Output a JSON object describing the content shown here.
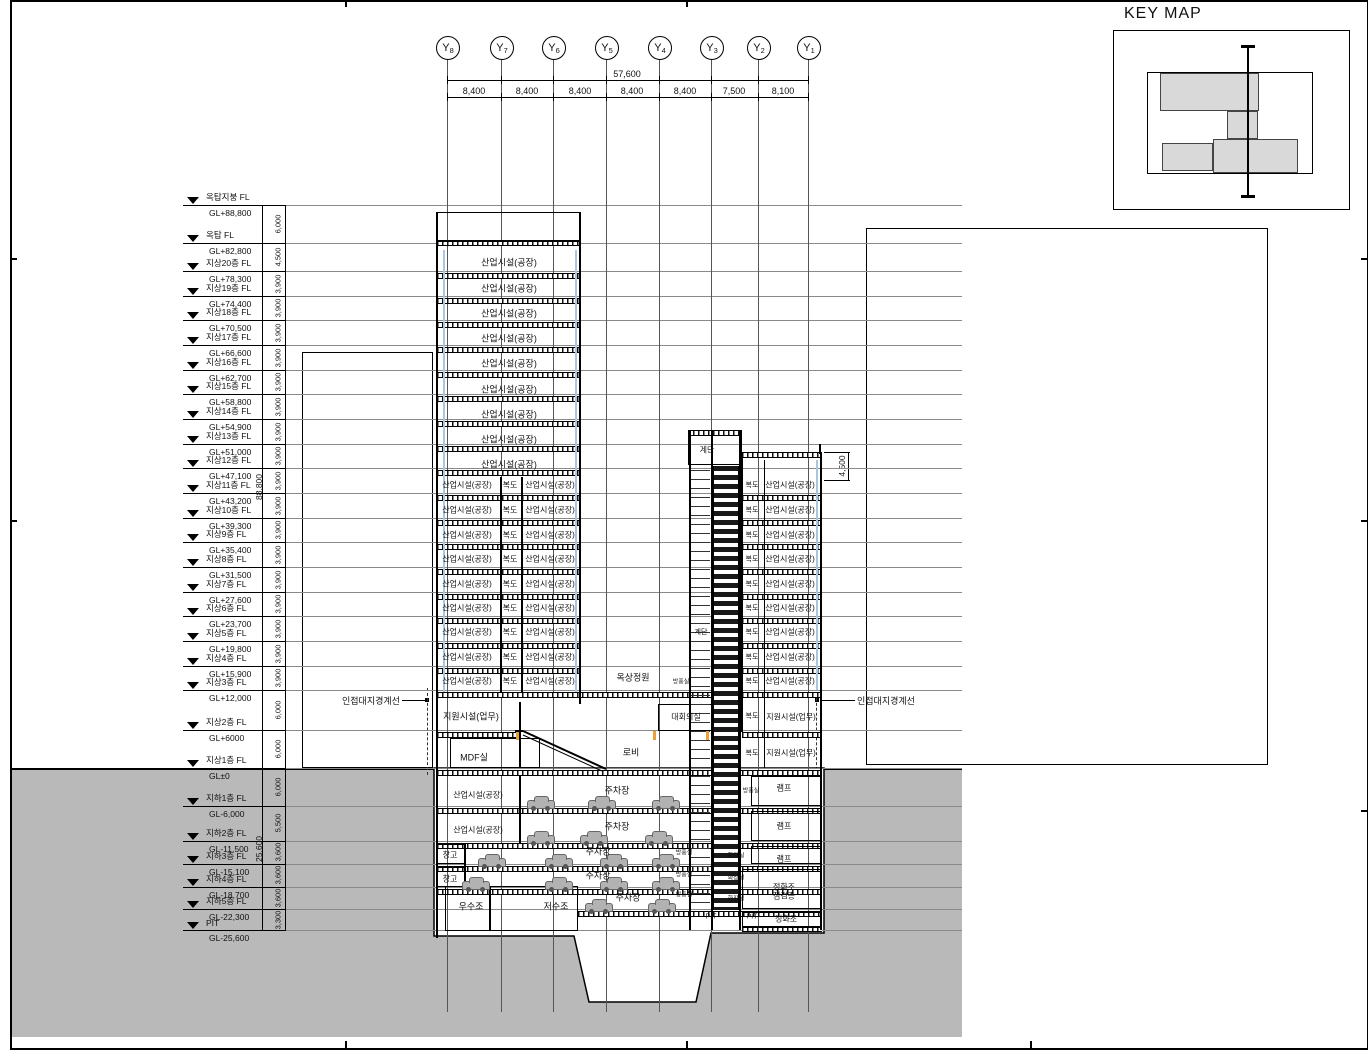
{
  "key_map": {
    "title": "KEY MAP"
  },
  "grid": {
    "overall": "57,600",
    "axis_prefix": "Y",
    "bubbles": [
      {
        "sub": "8",
        "x": 447
      },
      {
        "sub": "7",
        "x": 501
      },
      {
        "sub": "6",
        "x": 553
      },
      {
        "sub": "5",
        "x": 606
      },
      {
        "sub": "4",
        "x": 659
      },
      {
        "sub": "3",
        "x": 711
      },
      {
        "sub": "2",
        "x": 758
      },
      {
        "sub": "1",
        "x": 808
      }
    ],
    "spans": [
      {
        "t": "8,400",
        "x": 474
      },
      {
        "t": "8,400",
        "x": 527
      },
      {
        "t": "8,400",
        "x": 580
      },
      {
        "t": "8,400",
        "x": 632
      },
      {
        "t": "8,400",
        "x": 685
      },
      {
        "t": "7,500",
        "x": 734
      },
      {
        "t": "8,100",
        "x": 783
      }
    ]
  },
  "levels": [
    {
      "n": "옥탑지붕 FL",
      "gl": "GL+88,800",
      "y": 205
    },
    {
      "n": "옥탑 FL",
      "gl": "GL+82,800",
      "y": 243
    },
    {
      "n": "지상20층 FL",
      "gl": "GL+78,300",
      "y": 271
    },
    {
      "n": "지상19층 FL",
      "gl": "GL+74,400",
      "y": 296
    },
    {
      "n": "지상18층 FL",
      "gl": "GL+70,500",
      "y": 320
    },
    {
      "n": "지상17층 FL",
      "gl": "GL+66,600",
      "y": 345
    },
    {
      "n": "지상16층 FL",
      "gl": "GL+62,700",
      "y": 370
    },
    {
      "n": "지상15층 FL",
      "gl": "GL+58,800",
      "y": 394
    },
    {
      "n": "지상14층 FL",
      "gl": "GL+54,900",
      "y": 419
    },
    {
      "n": "지상13층 FL",
      "gl": "GL+51,000",
      "y": 444
    },
    {
      "n": "지상12층 FL",
      "gl": "GL+47,100",
      "y": 468
    },
    {
      "n": "지상11층 FL",
      "gl": "GL+43,200",
      "y": 493
    },
    {
      "n": "지상10층 FL",
      "gl": "GL+39,300",
      "y": 518
    },
    {
      "n": "지상9층 FL",
      "gl": "GL+35,400",
      "y": 542
    },
    {
      "n": "지상8층 FL",
      "gl": "GL+31,500",
      "y": 567
    },
    {
      "n": "지상7층 FL",
      "gl": "GL+27,600",
      "y": 592
    },
    {
      "n": "지상6층 FL",
      "gl": "GL+23,700",
      "y": 616
    },
    {
      "n": "지상5층 FL",
      "gl": "GL+19,800",
      "y": 641
    },
    {
      "n": "지상4층 FL",
      "gl": "GL+15,900",
      "y": 666
    },
    {
      "n": "지상3층 FL",
      "gl": "GL+12,000",
      "y": 690
    },
    {
      "n": "지상2층 FL",
      "gl": "GL+6000",
      "y": 730
    },
    {
      "n": "지상1층 FL",
      "gl": "GL±0",
      "y": 768
    },
    {
      "n": "지하1층 FL",
      "gl": "GL-6,000",
      "y": 806
    },
    {
      "n": "지하2층 FL",
      "gl": "GL-11,500",
      "y": 841
    },
    {
      "n": "지하3층 FL",
      "gl": "GL-15,100",
      "y": 864
    },
    {
      "n": "지하4층 FL",
      "gl": "GL-18,700",
      "y": 887
    },
    {
      "n": "지하5층 FL",
      "gl": "GL-22,300",
      "y": 909
    },
    {
      "n": "PIT",
      "gl": "GL-25,600",
      "y": 930
    }
  ],
  "left_dims": {
    "overall_above": "88,800",
    "overall_below": "25,600",
    "segs": [
      {
        "t": "6,000",
        "y": 224
      },
      {
        "t": "4,500",
        "y": 257
      },
      {
        "t": "3,900",
        "y": 284
      },
      {
        "t": "3,900",
        "y": 308
      },
      {
        "t": "3,900",
        "y": 333
      },
      {
        "t": "3,900",
        "y": 358
      },
      {
        "t": "3,900",
        "y": 382
      },
      {
        "t": "3,900",
        "y": 407
      },
      {
        "t": "3,900",
        "y": 432
      },
      {
        "t": "3,900",
        "y": 456
      },
      {
        "t": "3,900",
        "y": 481
      },
      {
        "t": "3,900",
        "y": 506
      },
      {
        "t": "3,900",
        "y": 530
      },
      {
        "t": "3,900",
        "y": 555
      },
      {
        "t": "3,900",
        "y": 580
      },
      {
        "t": "3,900",
        "y": 604
      },
      {
        "t": "3,900",
        "y": 629
      },
      {
        "t": "3,900",
        "y": 654
      },
      {
        "t": "3,900",
        "y": 678
      },
      {
        "t": "6,000",
        "y": 710
      },
      {
        "t": "6,000",
        "y": 749
      },
      {
        "t": "6,000",
        "y": 787
      },
      {
        "t": "5,500",
        "y": 823
      },
      {
        "t": "3,600",
        "y": 852
      },
      {
        "t": "3,600",
        "y": 875
      },
      {
        "t": "3,600",
        "y": 898
      },
      {
        "t": "3,300",
        "y": 920
      }
    ]
  },
  "right_dim": {
    "t": "4,500"
  },
  "annotations": {
    "boundary_left": "인접대지경계선",
    "boundary_right": "인접대지경계선"
  },
  "drawing": {
    "rooms": [
      {
        "t": "산업시설(공장)",
        "x": 509,
        "y": 262
      },
      {
        "t": "산업시설(공장)",
        "x": 509,
        "y": 288
      },
      {
        "t": "산업시설(공장)",
        "x": 509,
        "y": 313
      },
      {
        "t": "산업시설(공장)",
        "x": 509,
        "y": 338
      },
      {
        "t": "산업시설(공장)",
        "x": 509,
        "y": 363
      },
      {
        "t": "산업시설(공장)",
        "x": 509,
        "y": 389
      },
      {
        "t": "산업시설(공장)",
        "x": 509,
        "y": 414
      },
      {
        "t": "산업시설(공장)",
        "x": 509,
        "y": 439
      },
      {
        "t": "산업시설(공장)",
        "x": 509,
        "y": 464
      },
      {
        "t": "산업시설(공장)",
        "x": 467,
        "y": 485,
        "s": 8
      },
      {
        "t": "복도",
        "x": 510,
        "y": 485,
        "s": 8
      },
      {
        "t": "산업시설(공장)",
        "x": 550,
        "y": 485,
        "s": 8
      },
      {
        "t": "산업시설(공장)",
        "x": 467,
        "y": 510,
        "s": 8
      },
      {
        "t": "복도",
        "x": 510,
        "y": 510,
        "s": 8
      },
      {
        "t": "산업시설(공장)",
        "x": 550,
        "y": 510,
        "s": 8
      },
      {
        "t": "산업시설(공장)",
        "x": 467,
        "y": 535,
        "s": 8
      },
      {
        "t": "복도",
        "x": 510,
        "y": 535,
        "s": 8
      },
      {
        "t": "산업시설(공장)",
        "x": 550,
        "y": 535,
        "s": 8
      },
      {
        "t": "산업시설(공장)",
        "x": 467,
        "y": 559,
        "s": 8
      },
      {
        "t": "복도",
        "x": 510,
        "y": 559,
        "s": 8
      },
      {
        "t": "산업시설(공장)",
        "x": 550,
        "y": 559,
        "s": 8
      },
      {
        "t": "산업시설(공장)",
        "x": 467,
        "y": 584,
        "s": 8
      },
      {
        "t": "복도",
        "x": 510,
        "y": 584,
        "s": 8
      },
      {
        "t": "산업시설(공장)",
        "x": 550,
        "y": 584,
        "s": 8
      },
      {
        "t": "산업시설(공장)",
        "x": 467,
        "y": 608,
        "s": 8
      },
      {
        "t": "복도",
        "x": 510,
        "y": 608,
        "s": 8
      },
      {
        "t": "산업시설(공장)",
        "x": 550,
        "y": 608,
        "s": 8
      },
      {
        "t": "산업시설(공장)",
        "x": 467,
        "y": 632,
        "s": 8
      },
      {
        "t": "복도",
        "x": 510,
        "y": 632,
        "s": 8
      },
      {
        "t": "산업시설(공장)",
        "x": 550,
        "y": 632,
        "s": 8
      },
      {
        "t": "산업시설(공장)",
        "x": 467,
        "y": 657,
        "s": 8
      },
      {
        "t": "복도",
        "x": 510,
        "y": 657,
        "s": 8
      },
      {
        "t": "산업시설(공장)",
        "x": 550,
        "y": 657,
        "s": 8
      },
      {
        "t": "산업시설(공장)",
        "x": 467,
        "y": 681,
        "s": 8
      },
      {
        "t": "복도",
        "x": 510,
        "y": 681,
        "s": 8
      },
      {
        "t": "산업시설(공장)",
        "x": 550,
        "y": 681,
        "s": 8
      },
      {
        "t": "복도",
        "x": 752,
        "y": 485,
        "s": 7
      },
      {
        "t": "산업시설(공장)",
        "x": 790,
        "y": 485,
        "s": 8
      },
      {
        "t": "복도",
        "x": 752,
        "y": 510,
        "s": 7
      },
      {
        "t": "산업시설(공장)",
        "x": 790,
        "y": 510,
        "s": 8
      },
      {
        "t": "복도",
        "x": 752,
        "y": 535,
        "s": 7
      },
      {
        "t": "산업시설(공장)",
        "x": 790,
        "y": 535,
        "s": 8
      },
      {
        "t": "복도",
        "x": 752,
        "y": 559,
        "s": 7
      },
      {
        "t": "산업시설(공장)",
        "x": 790,
        "y": 559,
        "s": 8
      },
      {
        "t": "복도",
        "x": 752,
        "y": 584,
        "s": 7
      },
      {
        "t": "산업시설(공장)",
        "x": 790,
        "y": 584,
        "s": 8
      },
      {
        "t": "복도",
        "x": 752,
        "y": 608,
        "s": 7
      },
      {
        "t": "산업시설(공장)",
        "x": 790,
        "y": 608,
        "s": 8
      },
      {
        "t": "복도",
        "x": 752,
        "y": 632,
        "s": 7
      },
      {
        "t": "산업시설(공장)",
        "x": 790,
        "y": 632,
        "s": 8
      },
      {
        "t": "복도",
        "x": 752,
        "y": 657,
        "s": 7
      },
      {
        "t": "산업시설(공장)",
        "x": 790,
        "y": 657,
        "s": 8
      },
      {
        "t": "복도",
        "x": 752,
        "y": 681,
        "s": 7
      },
      {
        "t": "산업시설(공장)",
        "x": 790,
        "y": 681,
        "s": 8
      },
      {
        "t": "옥상정원",
        "x": 633,
        "y": 677
      },
      {
        "t": "방풍실",
        "x": 681,
        "y": 681,
        "s": 6
      },
      {
        "t": "지원시설(업무)",
        "x": 471,
        "y": 716
      },
      {
        "t": "대회의실",
        "x": 686,
        "y": 717,
        "s": 8
      },
      {
        "t": "복도",
        "x": 752,
        "y": 716,
        "s": 7
      },
      {
        "t": "지원시설(업무)",
        "x": 791,
        "y": 717,
        "s": 8
      },
      {
        "t": "MDF실",
        "x": 474,
        "y": 757
      },
      {
        "t": "로비",
        "x": 631,
        "y": 752
      },
      {
        "t": "복도",
        "x": 752,
        "y": 753,
        "s": 7
      },
      {
        "t": "지원시설(업무)",
        "x": 791,
        "y": 753,
        "s": 8
      },
      {
        "t": "계단",
        "x": 707,
        "y": 450,
        "s": 8
      },
      {
        "t": "계단",
        "x": 701,
        "y": 632,
        "s": 7
      },
      {
        "t": "산업시설(공장)",
        "x": 478,
        "y": 795,
        "s": 8
      },
      {
        "t": "주차장",
        "x": 617,
        "y": 790
      },
      {
        "t": "램프",
        "x": 784,
        "y": 788,
        "s": 8
      },
      {
        "t": "방풍실",
        "x": 751,
        "y": 790,
        "s": 6
      },
      {
        "t": "산업시설(공장)",
        "x": 478,
        "y": 830,
        "s": 8
      },
      {
        "t": "주차장",
        "x": 617,
        "y": 826
      },
      {
        "t": "램프",
        "x": 784,
        "y": 826,
        "s": 8
      },
      {
        "t": "창고",
        "x": 450,
        "y": 855,
        "s": 8
      },
      {
        "t": "주차장",
        "x": 598,
        "y": 851
      },
      {
        "t": "램프",
        "x": 784,
        "y": 859,
        "s": 8
      },
      {
        "t": "화장실",
        "x": 736,
        "y": 855,
        "s": 6
      },
      {
        "t": "방풍실",
        "x": 684,
        "y": 852,
        "s": 6
      },
      {
        "t": "창고",
        "x": 450,
        "y": 879,
        "s": 8
      },
      {
        "t": "주차장",
        "x": 598,
        "y": 875
      },
      {
        "t": "정화조",
        "x": 784,
        "y": 887,
        "s": 8
      },
      {
        "t": "점검층",
        "x": 784,
        "y": 896,
        "s": 8
      },
      {
        "t": "화장실",
        "x": 736,
        "y": 877,
        "s": 6
      },
      {
        "t": "방풍실",
        "x": 684,
        "y": 874,
        "s": 6
      },
      {
        "t": "우수조",
        "x": 471,
        "y": 906
      },
      {
        "t": "저수조",
        "x": 556,
        "y": 906
      },
      {
        "t": "주차장",
        "x": 628,
        "y": 897
      },
      {
        "t": "PIT",
        "x": 711,
        "y": 917,
        "s": 7
      },
      {
        "t": "PIT",
        "x": 752,
        "y": 917,
        "s": 7
      },
      {
        "t": "정화조",
        "x": 786,
        "y": 919,
        "s": 8
      },
      {
        "t": "화장실",
        "x": 736,
        "y": 898,
        "s": 6
      },
      {
        "t": "방풍실",
        "x": 684,
        "y": 894,
        "s": 6
      }
    ],
    "bands": [
      [
        437,
        240,
        144
      ],
      [
        437,
        273,
        144
      ],
      [
        437,
        298,
        144
      ],
      [
        437,
        322,
        144
      ],
      [
        437,
        347,
        144
      ],
      [
        437,
        372,
        144
      ],
      [
        437,
        396,
        144
      ],
      [
        437,
        421,
        144
      ],
      [
        437,
        446,
        144
      ],
      [
        437,
        470,
        144
      ],
      [
        437,
        495,
        144
      ],
      [
        437,
        520,
        144
      ],
      [
        437,
        544,
        144
      ],
      [
        437,
        569,
        144
      ],
      [
        437,
        594,
        144
      ],
      [
        437,
        618,
        144
      ],
      [
        437,
        643,
        144
      ],
      [
        437,
        668,
        144
      ],
      [
        437,
        692,
        385
      ],
      [
        688,
        430,
        54
      ],
      [
        742,
        452,
        80
      ],
      [
        742,
        495,
        80
      ],
      [
        742,
        520,
        80
      ],
      [
        742,
        544,
        80
      ],
      [
        742,
        569,
        80
      ],
      [
        742,
        594,
        80
      ],
      [
        742,
        618,
        80
      ],
      [
        742,
        643,
        80
      ],
      [
        742,
        668,
        80
      ],
      [
        437,
        732,
        84
      ],
      [
        742,
        732,
        80
      ],
      [
        437,
        770,
        385
      ],
      [
        437,
        808,
        385
      ],
      [
        437,
        843,
        385
      ],
      [
        437,
        866,
        385
      ],
      [
        437,
        889,
        385
      ],
      [
        578,
        911,
        244
      ],
      [
        742,
        926,
        80
      ]
    ],
    "walls": [
      [
        436,
        212,
        2,
        726
      ],
      [
        579,
        212,
        2,
        492
      ],
      [
        500,
        477,
        1.5,
        216
      ],
      [
        521,
        477,
        1.5,
        216
      ],
      [
        519,
        702,
        1.5,
        66
      ],
      [
        519,
        775,
        1.5,
        68
      ],
      [
        464,
        843,
        1.5,
        44
      ],
      [
        689,
        430,
        1.5,
        500
      ],
      [
        711,
        430,
        1.5,
        500
      ],
      [
        739,
        430,
        1.5,
        500
      ],
      [
        741,
        452,
        1.5,
        280
      ],
      [
        820,
        452,
        2,
        478
      ],
      [
        764,
        460,
        1,
        308
      ],
      [
        819,
        444,
        2,
        10
      ]
    ],
    "boxes": [
      [
        437,
        212,
        144,
        30
      ],
      [
        688,
        430,
        54,
        35
      ],
      [
        450,
        738,
        90,
        30
      ],
      [
        658,
        704,
        54,
        27
      ],
      [
        445,
        886,
        45,
        45
      ],
      [
        490,
        886,
        88,
        45
      ],
      [
        751,
        776,
        70,
        30
      ],
      [
        751,
        811,
        70,
        30
      ],
      [
        751,
        846,
        70,
        18
      ],
      [
        742,
        869,
        79,
        40
      ],
      [
        742,
        912,
        79,
        16
      ],
      [
        437,
        844,
        28,
        20
      ],
      [
        437,
        867,
        28,
        20
      ]
    ],
    "glazing": [
      [
        443,
        250,
        442
      ],
      [
        575,
        250,
        442
      ],
      [
        816,
        460,
        230
      ]
    ],
    "cars": [
      [
        527,
        800
      ],
      [
        588,
        800
      ],
      [
        652,
        800
      ],
      [
        527,
        835
      ],
      [
        580,
        835
      ],
      [
        645,
        835
      ],
      [
        478,
        858
      ],
      [
        545,
        858
      ],
      [
        600,
        858
      ],
      [
        652,
        858
      ],
      [
        462,
        881
      ],
      [
        545,
        881
      ],
      [
        600,
        881
      ],
      [
        652,
        881
      ],
      [
        585,
        903
      ],
      [
        648,
        903
      ]
    ],
    "orange_ticks": [
      [
        516,
        731
      ],
      [
        653,
        731
      ],
      [
        706,
        731
      ]
    ]
  }
}
